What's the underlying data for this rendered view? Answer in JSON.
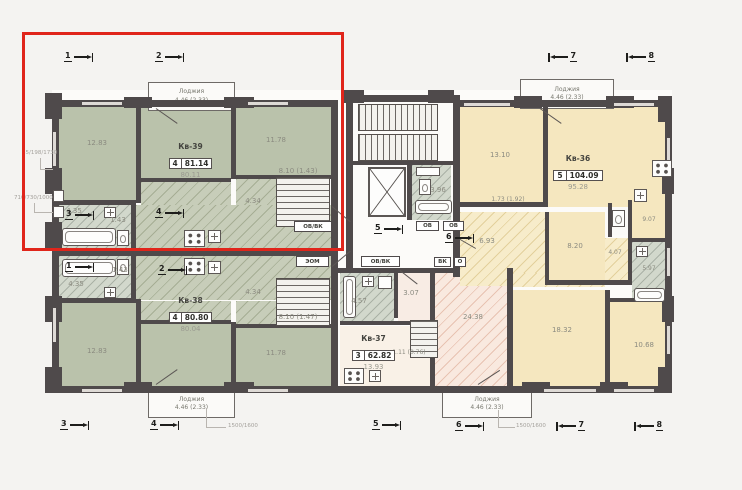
{
  "colors": {
    "highlight": "#e0251b",
    "walls": "#4f4a4b",
    "apartment_green": "#bac2ab",
    "apartment_yellow": "#f5e7bf",
    "apartment_pink": "#f9e9df",
    "background": "#f4f3f1"
  },
  "apartments": {
    "kv39": {
      "name": "Кв-39",
      "rooms": "4",
      "total": "81.14",
      "sub": "80.11"
    },
    "kv38": {
      "name": "Кв-38",
      "rooms": "4",
      "total": "80.80",
      "sub": "80.04"
    },
    "kv37": {
      "name": "Кв-37",
      "rooms": "3",
      "total": "62.82",
      "sub": "13.93"
    },
    "kv36": {
      "name": "Кв-36",
      "rooms": "5",
      "total": "104.09",
      "sub": "95.28"
    }
  },
  "room_areas": {
    "kv39_bed_left": "12.83",
    "kv39_bed_right": "11.78",
    "kv39_bath": "4.35",
    "kv39_hall": "1.43",
    "kv39_corridor": "4.34",
    "kv39_stairs": "8.10 (1.43)",
    "kv38_bed_left": "12.83",
    "kv38_bed_right": "11.78",
    "kv38_bath": "4.35",
    "kv38_hall": "1.43",
    "kv38_corridor": "4.34",
    "kv38_stairs": "8.10 (1.47)",
    "core_bath": "3.96",
    "kv37_bath": "4.57",
    "kv37_hall": "3.07",
    "kv37_room": "24.38",
    "kv37_stairs": "1.11 (0.76)",
    "kv36_room1": "13.10",
    "kv36_wardrobe": "1.73 (1.92)",
    "kv36_corridor": "6.93",
    "kv36_room2": "8.20",
    "kv36_hall": "4.07",
    "kv36_room3": "9.07",
    "kv36_bath": "5.97",
    "kv36_room4": "18.32",
    "kv36_room5": "10.68"
  },
  "balcony": {
    "label": "Лоджия",
    "value": "4.46 (2.33)"
  },
  "tech": {
    "ovvk": "ОВ/ВК",
    "eom": "ЭОМ",
    "ov": "ОВ",
    "vk": "ВК",
    "o": "О"
  },
  "dims": {
    "left_top": "85/198/1730",
    "left_bottom": "710/730/1000",
    "balcony_note": "1500/1600"
  },
  "sections": {
    "s1": "1",
    "s2": "2",
    "s3": "3",
    "s4": "4",
    "s5": "5",
    "s6": "6",
    "s7": "7",
    "s8": "8"
  }
}
